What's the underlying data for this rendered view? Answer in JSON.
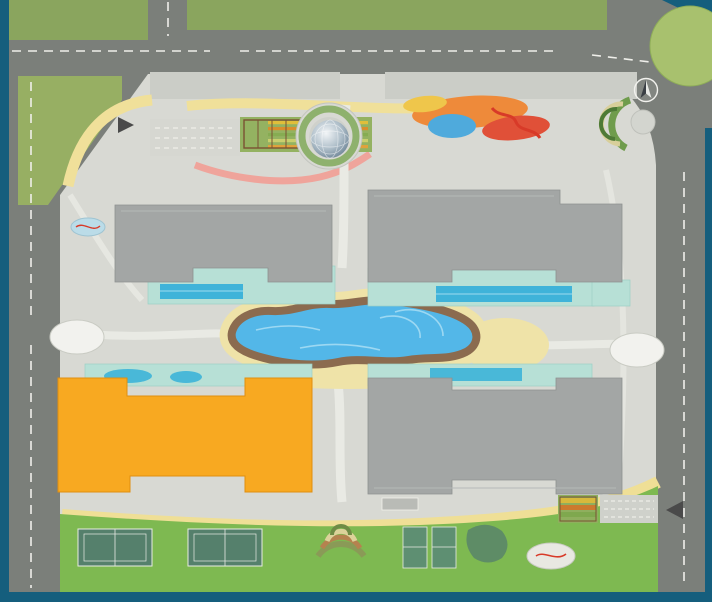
{
  "map": {
    "project_arc_label": "PARKHILL",
    "pool_label": "PARKHILL PREMIUM",
    "compass_label": "B",
    "buildings": {
      "park9": "PARK 9",
      "park10": "PARK 10",
      "park11": "PARK 11",
      "park12": "PARK 12"
    },
    "highlighted_building": "PARK 12",
    "colors": {
      "marker_orange": "#EC681C",
      "building_gray": "#A3A6A5",
      "highlight_orange": "#F8A921",
      "highlight_text_red": "#E8231F",
      "water_blue": "#53B7E8",
      "road_gray": "#7B7F7A",
      "paving": "#D8D9D3",
      "lawn_green": "#7EB951",
      "sand_beige": "#EFE3A8",
      "deck_brown": "#8B6B4F",
      "pool_deck_aqua": "#B7E0D6",
      "court_green": "#55806C",
      "frame_teal": "#155E7D",
      "arc_text_yellow": "#F4D22C"
    },
    "markers": [
      {
        "n": "01",
        "x": 691,
        "y": 55
      },
      {
        "n": "02",
        "x": 630,
        "y": 122
      },
      {
        "n": "03",
        "x": 558,
        "y": 103
      },
      {
        "n": "04",
        "x": 497,
        "y": 127
      },
      {
        "n": "05",
        "x": 433,
        "y": 108
      },
      {
        "n": "06",
        "x": 487,
        "y": 146
      },
      {
        "n": "06",
        "x": 628,
        "y": 574
      },
      {
        "n": "07",
        "x": 458,
        "y": 153
      },
      {
        "n": "08",
        "x": 159,
        "y": 169
      },
      {
        "n": "08",
        "x": 519,
        "y": 177
      },
      {
        "n": "09",
        "x": 325,
        "y": 130
      },
      {
        "n": "10",
        "x": 334,
        "y": 87
      },
      {
        "n": "11",
        "x": 262,
        "y": 129
      },
      {
        "n": "12",
        "x": 226,
        "y": 112
      },
      {
        "n": "12",
        "x": 341,
        "y": 562
      },
      {
        "n": "13",
        "x": 236,
        "y": 82
      },
      {
        "n": "13",
        "x": 464,
        "y": 80
      },
      {
        "n": "14",
        "x": 337,
        "y": 198
      },
      {
        "n": "15",
        "x": 322,
        "y": 230
      },
      {
        "n": "15",
        "x": 341,
        "y": 437
      },
      {
        "n": "16",
        "x": 333,
        "y": 303
      },
      {
        "n": "17",
        "x": 342,
        "y": 325
      },
      {
        "n": "18",
        "x": 342,
        "y": 358
      },
      {
        "n": "19",
        "x": 251,
        "y": 329
      },
      {
        "n": "19",
        "x": 449,
        "y": 359
      },
      {
        "n": "20",
        "x": 497,
        "y": 341
      },
      {
        "n": "21",
        "x": 157,
        "y": 335
      },
      {
        "n": "21",
        "x": 561,
        "y": 332
      },
      {
        "n": "22",
        "x": 77,
        "y": 333
      },
      {
        "n": "22",
        "x": 637,
        "y": 347
      },
      {
        "n": "23",
        "x": 205,
        "y": 492
      },
      {
        "n": "23",
        "x": 511,
        "y": 500
      },
      {
        "n": "24",
        "x": 163,
        "y": 512
      },
      {
        "n": "25",
        "x": 137,
        "y": 552
      },
      {
        "n": "25",
        "x": 238,
        "y": 552
      },
      {
        "n": "26",
        "x": 407,
        "y": 546
      },
      {
        "n": "26",
        "x": 445,
        "y": 547
      },
      {
        "n": "27",
        "x": 480,
        "y": 537
      },
      {
        "n": "28",
        "x": 82,
        "y": 224
      },
      {
        "n": "28",
        "x": 551,
        "y": 553
      },
      {
        "n": "29",
        "x": 180,
        "y": 137
      },
      {
        "n": "29",
        "x": 618,
        "y": 510
      },
      {
        "n": "30",
        "x": 76,
        "y": 122
      }
    ]
  }
}
